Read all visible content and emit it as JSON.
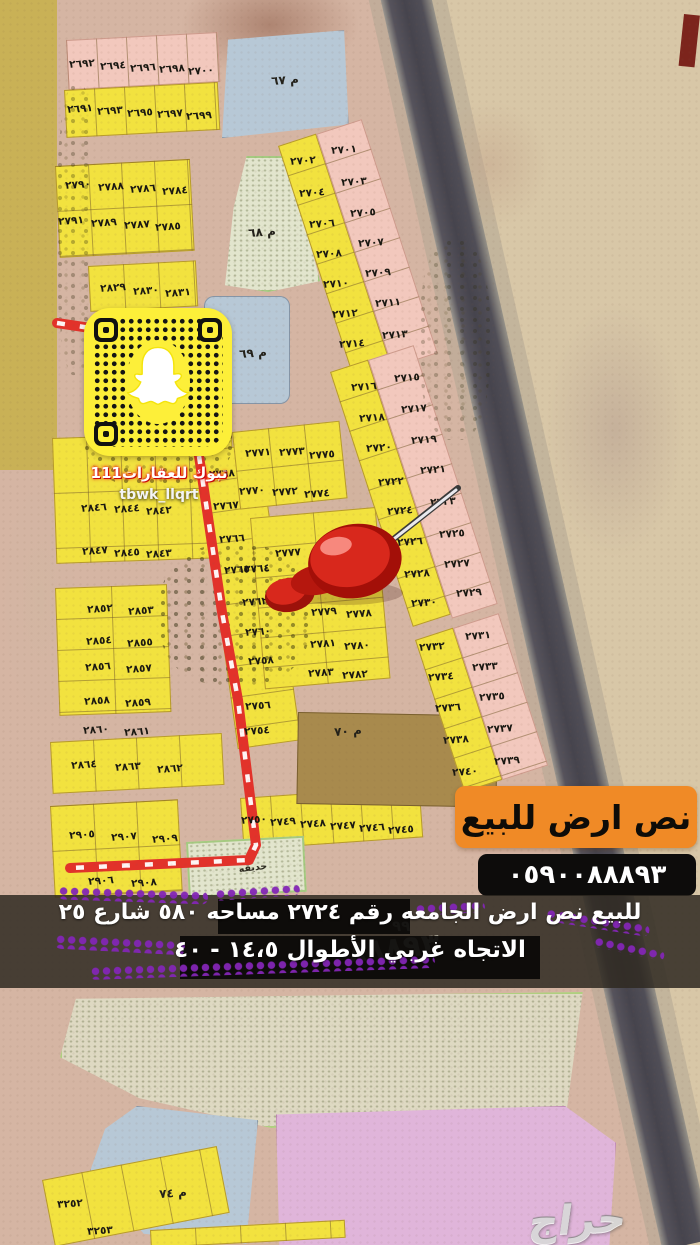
{
  "snapcode": {
    "account_name": "تبوك للعقارات111",
    "handle": "tbwk_llqrt"
  },
  "sale_banner": {
    "text": "نص ارض للبيع",
    "bg": "#f08a26"
  },
  "phone_badge": {
    "number": "٠٥٩٠٠٨٨٨٩٣",
    "bg": "#0d0c0b"
  },
  "caption": {
    "line1": "للبيع نص ارض الجامعه رقم ٢٧٢٤ مساحه ٥٨٠ شارع ٢٥",
    "line2": "الاتجاه غربي الأطوال ١٤،٥ - ٤٠",
    "ghost_digits": "٨٨٨٩٣",
    "ghost_digits_2": "٩٩"
  },
  "watermark": {
    "text": "حراج"
  },
  "map": {
    "route_main": "199,456 222,612 238,700 256,845 249,860 70,868",
    "route_stub": "57,323 97,329",
    "colors": {
      "yellow": "#f2e23f",
      "pink": "#f2c8bd",
      "blue": "#b7c8d6",
      "garden": "#e2e5cd",
      "brown": "#a8894e",
      "big_pink": "#e0b5da",
      "olive": "#c9b156",
      "route_red": "#e2322a",
      "highway": "#4a4850",
      "banner_orange": "#f08a26"
    },
    "blocks": [
      {
        "x": 0,
        "y": 0,
        "w": 57,
        "h": 470,
        "c": "o"
      },
      {
        "x": 66,
        "y": 40,
        "w": 152,
        "h": 50,
        "c": "p",
        "r": -3,
        "cw": 30
      },
      {
        "x": 64,
        "y": 90,
        "w": 154,
        "h": 48,
        "c": "y",
        "r": -3,
        "cw": 30
      },
      {
        "x": 222,
        "y": 26,
        "w": 130,
        "h": 112,
        "c": "b",
        "r": 2,
        "cp": "polygon(5% 12%, 94% 0%, 100% 84%, 3% 100%)"
      },
      {
        "x": 55,
        "y": 166,
        "w": 135,
        "h": 92,
        "c": "y",
        "r": -3,
        "ch": 45,
        "cw": 33
      },
      {
        "x": 88,
        "y": 266,
        "w": 108,
        "h": 46,
        "c": "y",
        "r": -3,
        "cw": 35
      },
      {
        "x": 212,
        "y": 156,
        "w": 108,
        "h": 136,
        "c": "e",
        "cp": "polygon(32% 0, 70% 0, 100% 92%, 52% 100%, 12% 95%, 20% 38%)"
      },
      {
        "x": 204,
        "y": 296,
        "w": 86,
        "h": 108,
        "c": "b",
        "br": 10
      },
      {
        "x": 52,
        "y": 438,
        "w": 180,
        "h": 126,
        "c": "y",
        "r": -2,
        "ch": 55,
        "cw": 34
      },
      {
        "x": 55,
        "y": 588,
        "w": 112,
        "h": 128,
        "c": "y",
        "r": -2,
        "ch": 31,
        "cw": 56
      },
      {
        "x": 50,
        "y": 742,
        "w": 172,
        "h": 52,
        "c": "y",
        "r": -3,
        "cw": 43
      },
      {
        "x": 50,
        "y": 806,
        "w": 128,
        "h": 92,
        "c": "y",
        "r": -3,
        "ch": 45,
        "cw": 43
      },
      {
        "x": 196,
        "y": 452,
        "w": 64,
        "h": 300,
        "c": "y",
        "r": -8,
        "ch": 31
      },
      {
        "x": 232,
        "y": 432,
        "w": 108,
        "h": 78,
        "c": "y",
        "r": -6,
        "ch": 39,
        "cw": 36
      },
      {
        "x": 250,
        "y": 518,
        "w": 126,
        "h": 172,
        "c": "y",
        "r": -5,
        "ch": 30,
        "cw": 63
      },
      {
        "x": 240,
        "y": 798,
        "w": 180,
        "h": 52,
        "c": "y",
        "r": -4,
        "cw": 30
      },
      {
        "x": 298,
        "y": 712,
        "w": 200,
        "h": 92,
        "c": "n",
        "r": 1
      },
      {
        "x": 186,
        "y": 842,
        "w": 118,
        "h": 56,
        "c": "e",
        "r": -3
      },
      {
        "x": 278,
        "y": 146,
        "w": 40,
        "h": 240,
        "c": "y",
        "r": -18,
        "ch": 31
      },
      {
        "x": 316,
        "y": 134,
        "w": 48,
        "h": 246,
        "c": "p",
        "r": -18,
        "ch": 31
      },
      {
        "x": 330,
        "y": 372,
        "w": 40,
        "h": 268,
        "c": "y",
        "r": -18,
        "ch": 31
      },
      {
        "x": 368,
        "y": 360,
        "w": 48,
        "h": 272,
        "c": "p",
        "r": -18,
        "ch": 31
      },
      {
        "x": 415,
        "y": 640,
        "w": 40,
        "h": 160,
        "c": "y",
        "r": -18,
        "ch": 31
      },
      {
        "x": 453,
        "y": 628,
        "w": 48,
        "h": 160,
        "c": "p",
        "r": -18,
        "ch": 31
      },
      {
        "x": 60,
        "y": 992,
        "w": 528,
        "h": 136,
        "c": "s",
        "cp": "polygon(3% 5%, 99% 0, 96% 86%, 40% 100%, 15% 78%, 0 48%)"
      },
      {
        "x": 90,
        "y": 1106,
        "w": 168,
        "h": 142,
        "c": "b",
        "cp": "polygon(28% 0, 100% 10%, 93% 97%, 32% 90%, 0 46%, 9% 16%)"
      },
      {
        "x": 276,
        "y": 1106,
        "w": 340,
        "h": 142,
        "c": "P",
        "cp": "polygon(0 6%, 85% 0, 100% 26%, 98% 100%, 1% 100%)"
      },
      {
        "x": 42,
        "y": 1180,
        "w": 178,
        "h": 68,
        "c": "y",
        "r": -11,
        "cw": 40
      },
      {
        "x": 150,
        "y": 1230,
        "w": 195,
        "h": 18,
        "c": "y",
        "r": -3,
        "cw": 45
      },
      {
        "x": 684,
        "y": 14,
        "w": 16,
        "h": 52,
        "c": "m",
        "r": 6
      }
    ],
    "labels": [
      {
        "t": "٢٦٩٢",
        "x": 82,
        "y": 64
      },
      {
        "t": "٢٦٩٤",
        "x": 113,
        "y": 66
      },
      {
        "t": "٢٦٩٦",
        "x": 143,
        "y": 68
      },
      {
        "t": "٢٦٩٨",
        "x": 172,
        "y": 69
      },
      {
        "t": "٢٧٠٠",
        "x": 201,
        "y": 71
      },
      {
        "t": "٢٦٩١",
        "x": 80,
        "y": 109
      },
      {
        "t": "٢٦٩٣",
        "x": 110,
        "y": 111
      },
      {
        "t": "٢٦٩٥",
        "x": 140,
        "y": 113
      },
      {
        "t": "٢٦٩٧",
        "x": 170,
        "y": 114
      },
      {
        "t": "٢٦٩٩",
        "x": 199,
        "y": 116
      },
      {
        "t": "م ٦٧",
        "x": 285,
        "y": 80,
        "k": "mu"
      },
      {
        "t": "٢٧٩٠",
        "x": 78,
        "y": 185
      },
      {
        "t": "٢٧٨٨",
        "x": 111,
        "y": 187
      },
      {
        "t": "٢٧٨٦",
        "x": 143,
        "y": 189
      },
      {
        "t": "٢٧٨٤",
        "x": 175,
        "y": 191
      },
      {
        "t": "٢٧٩١",
        "x": 71,
        "y": 221
      },
      {
        "t": "٢٧٨٩",
        "x": 104,
        "y": 223
      },
      {
        "t": "٢٧٨٧",
        "x": 137,
        "y": 225
      },
      {
        "t": "٢٧٨٥",
        "x": 168,
        "y": 227
      },
      {
        "t": "م ٦٨",
        "x": 262,
        "y": 232,
        "k": "mu"
      },
      {
        "t": "٢٨٢٩",
        "x": 113,
        "y": 288
      },
      {
        "t": "٢٨٣٠",
        "x": 146,
        "y": 291
      },
      {
        "t": "٢٨٣١",
        "x": 178,
        "y": 293
      },
      {
        "t": "م ٦٩",
        "x": 253,
        "y": 353,
        "k": "mu"
      },
      {
        "t": "٢٧٠٢",
        "x": 303,
        "y": 161
      },
      {
        "t": "٢٧٠٤",
        "x": 312,
        "y": 193
      },
      {
        "t": "٢٧٠٦",
        "x": 322,
        "y": 224
      },
      {
        "t": "٢٧٠٨",
        "x": 329,
        "y": 254
      },
      {
        "t": "٢٧١٠",
        "x": 336,
        "y": 284
      },
      {
        "t": "٢٧١٢",
        "x": 345,
        "y": 314
      },
      {
        "t": "٢٧١٤",
        "x": 352,
        "y": 344
      },
      {
        "t": "٢٧٠١",
        "x": 344,
        "y": 150
      },
      {
        "t": "٢٧٠٣",
        "x": 354,
        "y": 182
      },
      {
        "t": "٢٧٠٥",
        "x": 363,
        "y": 213
      },
      {
        "t": "٢٧٠٧",
        "x": 371,
        "y": 243
      },
      {
        "t": "٢٧٠٩",
        "x": 378,
        "y": 273
      },
      {
        "t": "٢٧١١",
        "x": 388,
        "y": 303
      },
      {
        "t": "٢٧١٣",
        "x": 395,
        "y": 335
      },
      {
        "t": "٢٧١٦",
        "x": 364,
        "y": 387
      },
      {
        "t": "٢٧١٨",
        "x": 372,
        "y": 418
      },
      {
        "t": "٢٧٢٠",
        "x": 379,
        "y": 448
      },
      {
        "t": "٢٧٢٢",
        "x": 391,
        "y": 482
      },
      {
        "t": "٢٧٢٤",
        "x": 400,
        "y": 511
      },
      {
        "t": "٢٧٢٦",
        "x": 410,
        "y": 542
      },
      {
        "t": "٢٧٢٨",
        "x": 417,
        "y": 574
      },
      {
        "t": "٢٧٣٠",
        "x": 424,
        "y": 603
      },
      {
        "t": "٢٧١٥",
        "x": 407,
        "y": 378
      },
      {
        "t": "٢٧١٧",
        "x": 414,
        "y": 409
      },
      {
        "t": "٢٧١٩",
        "x": 424,
        "y": 440
      },
      {
        "t": "٢٧٢١",
        "x": 433,
        "y": 470
      },
      {
        "t": "٢٧٢٣",
        "x": 443,
        "y": 502
      },
      {
        "t": "٢٧٢٥",
        "x": 452,
        "y": 534
      },
      {
        "t": "٢٧٢٧",
        "x": 457,
        "y": 564
      },
      {
        "t": "٢٧٢٩",
        "x": 469,
        "y": 593
      },
      {
        "t": "٢٧٣٢",
        "x": 432,
        "y": 647
      },
      {
        "t": "٢٧٣٤",
        "x": 441,
        "y": 677
      },
      {
        "t": "٢٧٣٦",
        "x": 448,
        "y": 708
      },
      {
        "t": "٢٧٣٨",
        "x": 456,
        "y": 740
      },
      {
        "t": "٢٧٤٠",
        "x": 465,
        "y": 772
      },
      {
        "t": "٢٧٣١",
        "x": 478,
        "y": 636
      },
      {
        "t": "٢٧٣٣",
        "x": 485,
        "y": 667
      },
      {
        "t": "٢٧٣٥",
        "x": 492,
        "y": 697
      },
      {
        "t": "٢٧٣٧",
        "x": 500,
        "y": 729
      },
      {
        "t": "٢٧٣٩",
        "x": 507,
        "y": 761
      },
      {
        "t": "٢٧٧١",
        "x": 258,
        "y": 453
      },
      {
        "t": "٢٧٧٣",
        "x": 292,
        "y": 452
      },
      {
        "t": "٢٧٧٥",
        "x": 322,
        "y": 455
      },
      {
        "t": "٢٧٧٠",
        "x": 252,
        "y": 491
      },
      {
        "t": "٢٧٧٢",
        "x": 285,
        "y": 492
      },
      {
        "t": "٢٧٧٤",
        "x": 317,
        "y": 494
      },
      {
        "t": "٢٧٧٧",
        "x": 288,
        "y": 553
      },
      {
        "t": "٢٧٧٦",
        "x": 332,
        "y": 557
      },
      {
        "t": "٢٧٧٩",
        "x": 324,
        "y": 612
      },
      {
        "t": "٢٧٧٨",
        "x": 359,
        "y": 614
      },
      {
        "t": "٢٧٨١",
        "x": 323,
        "y": 644
      },
      {
        "t": "٢٧٨٠",
        "x": 357,
        "y": 646
      },
      {
        "t": "٢٧٨٣",
        "x": 321,
        "y": 673
      },
      {
        "t": "٢٧٨٢",
        "x": 355,
        "y": 675
      },
      {
        "t": "٢٧٦٨",
        "x": 222,
        "y": 474
      },
      {
        "t": "٢٧٦٧",
        "x": 226,
        "y": 506
      },
      {
        "t": "٢٧٦٦",
        "x": 232,
        "y": 539
      },
      {
        "t": "٢٧٦٥",
        "x": 237,
        "y": 570
      },
      {
        "t": "٢٧٦٤",
        "x": 257,
        "y": 569
      },
      {
        "t": "٢٧٦٢",
        "x": 255,
        "y": 602
      },
      {
        "t": "٢٧٦٠",
        "x": 258,
        "y": 632
      },
      {
        "t": "٢٧٥٨",
        "x": 261,
        "y": 661
      },
      {
        "t": "٢٧٥٦",
        "x": 258,
        "y": 706
      },
      {
        "t": "٢٧٥٤",
        "x": 257,
        "y": 731
      },
      {
        "t": "٢٨٤٦",
        "x": 94,
        "y": 508
      },
      {
        "t": "٢٨٤٤",
        "x": 127,
        "y": 509
      },
      {
        "t": "٢٨٤٢",
        "x": 159,
        "y": 511
      },
      {
        "t": "٢٨٤٧",
        "x": 95,
        "y": 551
      },
      {
        "t": "٢٨٤٥",
        "x": 127,
        "y": 553
      },
      {
        "t": "٢٨٤٣",
        "x": 159,
        "y": 554
      },
      {
        "t": "٢٨٥٢",
        "x": 100,
        "y": 609
      },
      {
        "t": "٢٨٥٣",
        "x": 141,
        "y": 611
      },
      {
        "t": "٢٨٥٤",
        "x": 99,
        "y": 641
      },
      {
        "t": "٢٨٥٥",
        "x": 140,
        "y": 643
      },
      {
        "t": "٢٨٥٦",
        "x": 98,
        "y": 667
      },
      {
        "t": "٢٨٥٧",
        "x": 139,
        "y": 669
      },
      {
        "t": "٢٨٥٨",
        "x": 97,
        "y": 701
      },
      {
        "t": "٢٨٥٩",
        "x": 138,
        "y": 703
      },
      {
        "t": "٢٨٦٠",
        "x": 96,
        "y": 730
      },
      {
        "t": "٢٨٦١",
        "x": 137,
        "y": 732
      },
      {
        "t": "٢٨٦٤",
        "x": 84,
        "y": 765
      },
      {
        "t": "٢٨٦٣",
        "x": 128,
        "y": 767
      },
      {
        "t": "٢٨٦٢",
        "x": 170,
        "y": 769
      },
      {
        "t": "٢٩٠٥",
        "x": 82,
        "y": 835
      },
      {
        "t": "٢٩٠٧",
        "x": 124,
        "y": 837
      },
      {
        "t": "٢٩٠٩",
        "x": 165,
        "y": 839
      },
      {
        "t": "٢٩٠٦",
        "x": 101,
        "y": 881
      },
      {
        "t": "٢٩٠٨",
        "x": 144,
        "y": 883
      },
      {
        "t": "٢٧٥٠",
        "x": 254,
        "y": 820
      },
      {
        "t": "٢٧٤٩",
        "x": 283,
        "y": 822
      },
      {
        "t": "٢٧٤٨",
        "x": 313,
        "y": 824
      },
      {
        "t": "٢٧٤٧",
        "x": 343,
        "y": 826
      },
      {
        "t": "٢٧٤٦",
        "x": 372,
        "y": 828
      },
      {
        "t": "٢٧٤٥",
        "x": 401,
        "y": 830
      },
      {
        "t": "م ٧٠",
        "x": 348,
        "y": 731,
        "k": "mu"
      },
      {
        "t": "حديقه",
        "x": 253,
        "y": 868,
        "k": "gd"
      },
      {
        "t": "٣٢٥٢",
        "x": 70,
        "y": 1204
      },
      {
        "t": "٣٢٥٣",
        "x": 100,
        "y": 1231
      },
      {
        "t": "م ٧٤",
        "x": 173,
        "y": 1193,
        "k": "mu"
      }
    ]
  }
}
